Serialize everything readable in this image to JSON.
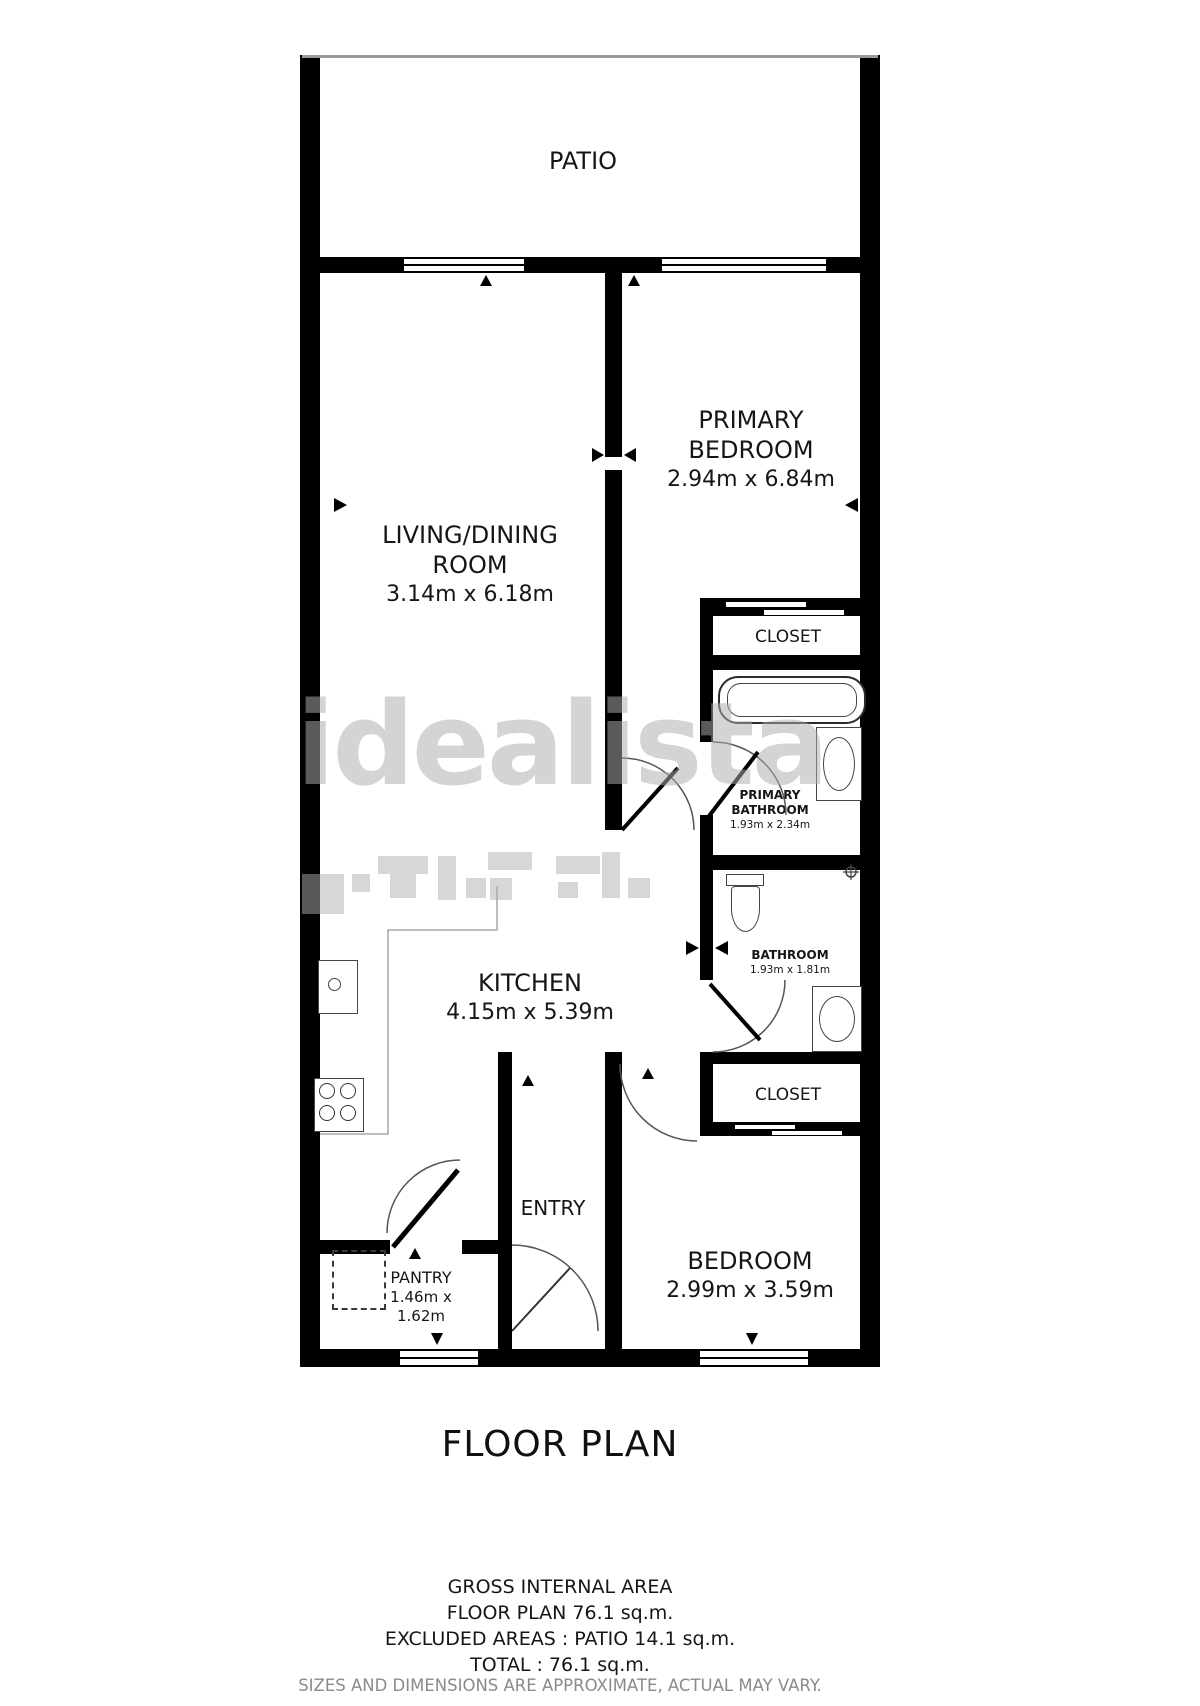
{
  "title": "FLOOR PLAN",
  "watermark": "idealista",
  "rooms": {
    "patio": {
      "name": "PATIO"
    },
    "living": {
      "name": "LIVING/DINING ROOM",
      "dims": "3.14m x 6.18m"
    },
    "primary_bedroom": {
      "name": "PRIMARY BEDROOM",
      "dims": "2.94m x 6.84m"
    },
    "closet_top": {
      "name": "CLOSET"
    },
    "primary_bathroom": {
      "name": "PRIMARY BATHROOM",
      "dims": "1.93m x 2.34m"
    },
    "kitchen": {
      "name": "KITCHEN",
      "dims": "4.15m x 5.39m"
    },
    "bathroom": {
      "name": "BATHROOM",
      "dims": "1.93m x 1.81m"
    },
    "closet_bottom": {
      "name": "CLOSET"
    },
    "entry": {
      "name": "ENTRY"
    },
    "pantry": {
      "name": "PANTRY",
      "dims": "1.46m x 1.62m"
    },
    "bedroom": {
      "name": "BEDROOM",
      "dims": "2.99m x 3.59m"
    }
  },
  "summary": {
    "line1": "GROSS INTERNAL AREA",
    "line2": "FLOOR PLAN 76.1 sq.m.",
    "line3": "EXCLUDED AREAS :  PATIO 14.1 sq.m.",
    "line4": "TOTAL :  76.1 sq.m.",
    "disclaimer": "SIZES AND DIMENSIONS ARE APPROXIMATE, ACTUAL MAY VARY."
  },
  "colors": {
    "wall": "#000000",
    "text": "#161616",
    "watermark": "#acacac",
    "disclaimer": "#8a8a8a"
  }
}
